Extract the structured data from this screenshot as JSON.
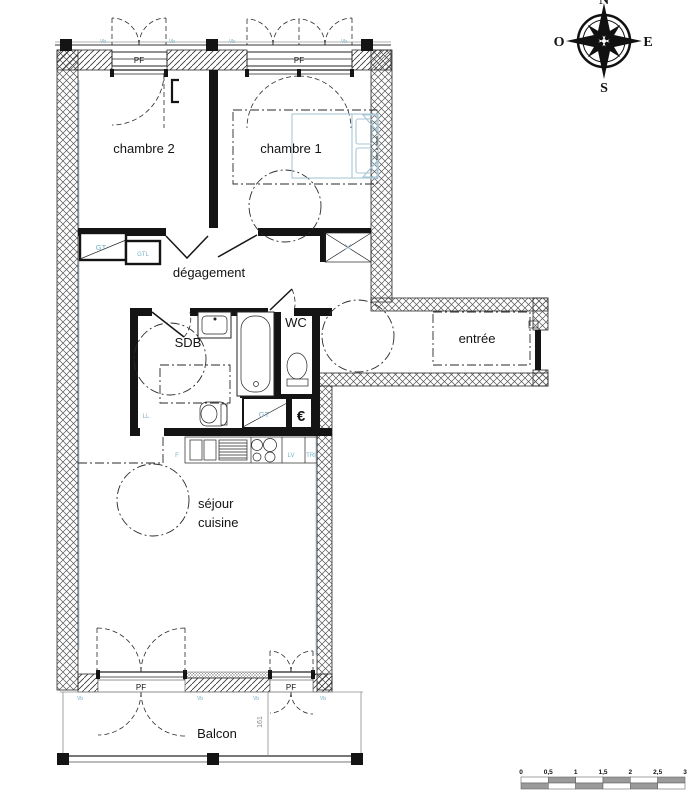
{
  "rooms": {
    "chambre2": "chambre 2",
    "chambre1": "chambre 1",
    "degagement": "dégagement",
    "sdb": "SDB",
    "wc": "WC",
    "entree": "entrée",
    "sejour": "séjour",
    "cuisine": "cuisine",
    "balcon": "Balcon"
  },
  "equipment": {
    "gt": "GT",
    "gtl": "GTL",
    "ll": "LL",
    "f": "F",
    "lv": "LV",
    "tri": "TRI",
    "euro": "€"
  },
  "windows": {
    "pf": "PF",
    "vb": "Vb"
  },
  "compass": {
    "n": "N",
    "s": "S",
    "e": "E",
    "o": "O"
  },
  "dimensions": {
    "balcony": "161"
  },
  "scale": {
    "ticks": [
      "0",
      "0,5",
      "1",
      "1,5",
      "2",
      "2,5",
      "3"
    ]
  },
  "colors": {
    "wall_black": "#141414",
    "hatch_gray": "#555555",
    "label_blue": "#79b0c6",
    "furniture_blue": "#a9c7d6",
    "dimension_gray": "#8a8a8a"
  }
}
